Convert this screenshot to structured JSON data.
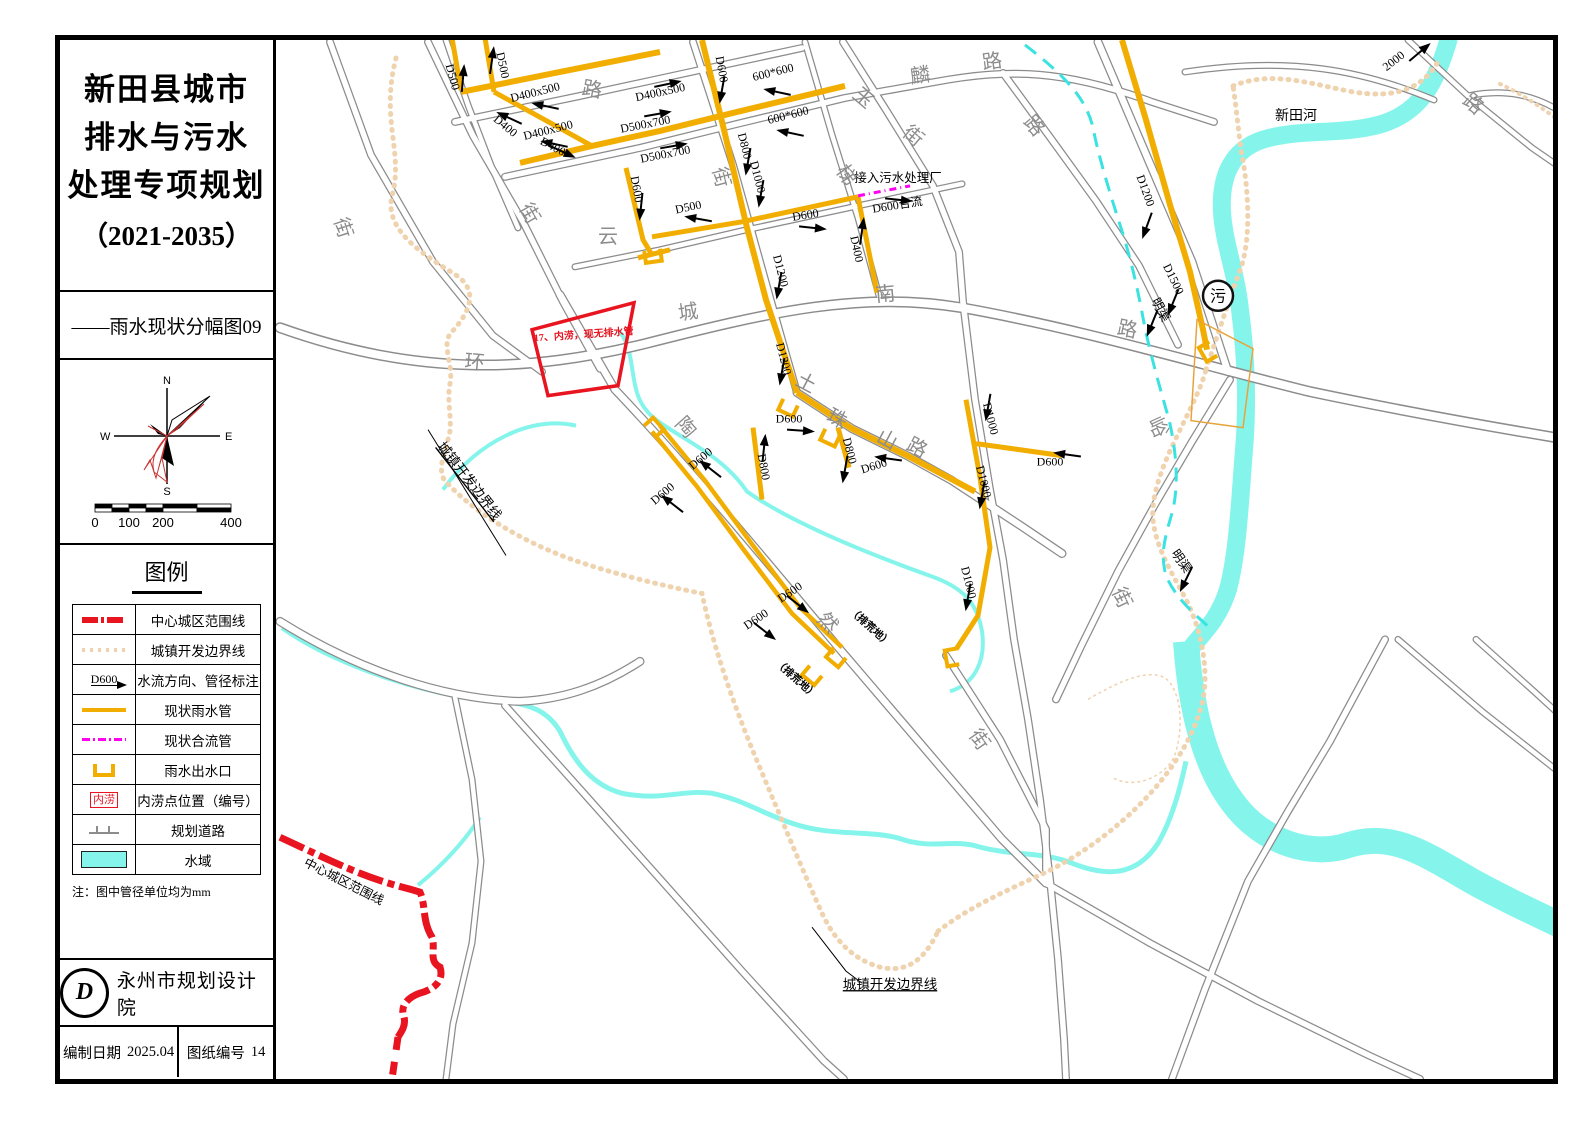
{
  "sidebar": {
    "title_lines": [
      "新田县城市",
      "排水与污水",
      "处理专项规划"
    ],
    "title_years": "（2021-2035）",
    "subtitle": "——雨水现状分幅图09",
    "compass": {
      "n": "N",
      "e": "E",
      "s": "S",
      "w": "W"
    },
    "scale": {
      "labels": [
        "0",
        "100",
        "200",
        "400"
      ]
    },
    "legend": {
      "heading": "图例",
      "flow_symbol_text": "D600",
      "flood_symbol_text": "内涝",
      "note": "注：图中管径单位均为mm",
      "items": [
        {
          "label": "中心城区范围线",
          "type": "red-dash"
        },
        {
          "label": "城镇开发边界线",
          "type": "tan-dot"
        },
        {
          "label": "水流方向、管径标注",
          "type": "flow"
        },
        {
          "label": "现状雨水管",
          "type": "rain-pipe"
        },
        {
          "label": "现状合流管",
          "type": "combined-pipe"
        },
        {
          "label": "雨水出水口",
          "type": "outfall"
        },
        {
          "label": "内涝点位置（编号）",
          "type": "flood-point"
        },
        {
          "label": "规划道路",
          "type": "planned-road"
        },
        {
          "label": "水域",
          "type": "water"
        }
      ]
    },
    "org": "永州市规划设计院",
    "logo_glyph": "D",
    "meta": {
      "date_label": "编制日期",
      "date": "2025.04",
      "sheet_label": "图纸编号",
      "sheet": "14"
    }
  },
  "map": {
    "colors": {
      "rain_pipe": "#F2AE00",
      "combined_pipe": "#FF00F0",
      "water": "#85F5EC",
      "boundary_urban": "#EFD3AF",
      "boundary_center": "#E81420",
      "road_casing": "#8C8C8C",
      "open_channel": "#3AE2E2"
    },
    "labels": [
      {
        "t": "D500",
        "x": 449,
        "y": 78,
        "r": 75
      },
      {
        "t": "D500",
        "x": 499,
        "y": 66,
        "r": 78
      },
      {
        "t": "D400x500",
        "x": 536,
        "y": 96,
        "r": -14
      },
      {
        "t": "D400x500",
        "x": 549,
        "y": 134,
        "r": -14
      },
      {
        "t": "D400x500",
        "x": 661,
        "y": 96,
        "r": -12
      },
      {
        "t": "D500x700",
        "x": 646,
        "y": 128,
        "r": -11
      },
      {
        "t": "D500x700",
        "x": 666,
        "y": 158,
        "r": -11
      },
      {
        "t": "D400",
        "x": 503,
        "y": 129,
        "r": 40
      },
      {
        "t": "D400",
        "x": 551,
        "y": 150,
        "r": 28
      },
      {
        "t": "D600",
        "x": 633,
        "y": 190,
        "r": 80
      },
      {
        "t": "D500",
        "x": 689,
        "y": 211,
        "r": -12
      },
      {
        "t": "D600",
        "x": 718,
        "y": 70,
        "r": 80
      },
      {
        "t": "D800",
        "x": 741,
        "y": 147,
        "r": 76
      },
      {
        "t": "D1000",
        "x": 754,
        "y": 178,
        "r": 76
      },
      {
        "t": "D1200",
        "x": 777,
        "y": 272,
        "r": 76
      },
      {
        "t": "600*600",
        "x": 774,
        "y": 76,
        "r": -14
      },
      {
        "t": "600*600",
        "x": 789,
        "y": 119,
        "r": -14
      },
      {
        "t": "D600",
        "x": 806,
        "y": 219,
        "r": -9
      },
      {
        "t": "D400",
        "x": 853,
        "y": 250,
        "r": 78
      },
      {
        "t": "D600合流",
        "x": 898,
        "y": 209,
        "r": -9
      },
      {
        "t": "D1200",
        "x": 780,
        "y": 360,
        "r": 76
      },
      {
        "t": "D600",
        "x": 789,
        "y": 423,
        "r": 0
      },
      {
        "t": "D800",
        "x": 846,
        "y": 452,
        "r": 76
      },
      {
        "t": "D600",
        "x": 875,
        "y": 470,
        "r": -17
      },
      {
        "t": "D800",
        "x": 760,
        "y": 468,
        "r": 80
      },
      {
        "t": "D1000",
        "x": 987,
        "y": 420,
        "r": 76
      },
      {
        "t": "D600",
        "x": 1050,
        "y": 466,
        "r": 0
      },
      {
        "t": "D1000",
        "x": 980,
        "y": 483,
        "r": 76
      },
      {
        "t": "D1000",
        "x": 965,
        "y": 584,
        "r": 76
      },
      {
        "t": "D600",
        "x": 792,
        "y": 596,
        "r": -34
      },
      {
        "t": "D600",
        "x": 758,
        "y": 623,
        "r": -34
      },
      {
        "t": "D600",
        "x": 703,
        "y": 462,
        "r": -40
      },
      {
        "t": "D600",
        "x": 665,
        "y": 497,
        "r": -40
      },
      {
        "t": "D1200",
        "x": 1142,
        "y": 192,
        "r": 70
      },
      {
        "t": "D1500",
        "x": 1170,
        "y": 281,
        "r": 64
      },
      {
        "t": "2000",
        "x": 1396,
        "y": 64,
        "r": -38
      },
      {
        "t": "接入污水处理厂",
        "x": 898,
        "y": 182,
        "r": 0,
        "c": "an"
      },
      {
        "t": "明渠",
        "x": 1157,
        "y": 312,
        "r": 62,
        "c": "an"
      },
      {
        "t": "明渠",
        "x": 1178,
        "y": 564,
        "r": 55,
        "c": "an"
      },
      {
        "t": "新田河",
        "x": 1296,
        "y": 120,
        "r": 0,
        "c": "riv"
      },
      {
        "t": "污",
        "x": 1218,
        "y": 302,
        "r": 0,
        "c": "plant"
      },
      {
        "t": "17、内涝，现无排水管",
        "x": 584,
        "y": 338,
        "r": -4,
        "c": "rc"
      },
      {
        "t": "城镇开发边界线",
        "x": 466,
        "y": 484,
        "r": 52,
        "c": "anu"
      },
      {
        "t": "城镇开发边界线",
        "x": 890,
        "y": 990,
        "r": 0,
        "c": "anu"
      },
      {
        "t": "中心城区范围线",
        "x": 342,
        "y": 886,
        "r": 27,
        "c": "an"
      },
      {
        "t": "（排荒地）",
        "x": 868,
        "y": 630,
        "r": 42,
        "c": "sm"
      },
      {
        "t": "（排荒地）",
        "x": 794,
        "y": 682,
        "r": 42,
        "c": "sm"
      },
      {
        "t": "街",
        "x": 337,
        "y": 230,
        "r": 72,
        "c": "rd"
      },
      {
        "t": "街",
        "x": 524,
        "y": 217,
        "r": 60,
        "c": "rd"
      },
      {
        "t": "路",
        "x": 591,
        "y": 96,
        "r": 10,
        "c": "rd"
      },
      {
        "t": "云",
        "x": 608,
        "y": 243,
        "r": 0,
        "c": "rd"
      },
      {
        "t": "街",
        "x": 715,
        "y": 179,
        "r": 75,
        "c": "rd"
      },
      {
        "t": "玉",
        "x": 859,
        "y": 103,
        "r": 40,
        "c": "rd"
      },
      {
        "t": "街",
        "x": 909,
        "y": 141,
        "r": 40,
        "c": "rd"
      },
      {
        "t": "麟",
        "x": 921,
        "y": 82,
        "r": -8,
        "c": "rd"
      },
      {
        "t": "路",
        "x": 993,
        "y": 68,
        "r": -8,
        "c": "rd"
      },
      {
        "t": "路",
        "x": 1029,
        "y": 130,
        "r": 50,
        "c": "rd"
      },
      {
        "t": "梯",
        "x": 841,
        "y": 179,
        "r": 55,
        "c": "rd"
      },
      {
        "t": "南",
        "x": 886,
        "y": 301,
        "r": -5,
        "c": "rd"
      },
      {
        "t": "路",
        "x": 1126,
        "y": 336,
        "r": 12,
        "c": "rd"
      },
      {
        "t": "城",
        "x": 689,
        "y": 319,
        "r": -8,
        "c": "rd"
      },
      {
        "t": "环",
        "x": 474,
        "y": 369,
        "r": 5,
        "c": "rd"
      },
      {
        "t": "陶",
        "x": 681,
        "y": 432,
        "r": 48,
        "c": "rd"
      },
      {
        "t": "土",
        "x": 803,
        "y": 389,
        "r": 28,
        "c": "rd"
      },
      {
        "t": "珠",
        "x": 834,
        "y": 425,
        "r": 28,
        "c": "rd"
      },
      {
        "t": "山",
        "x": 884,
        "y": 446,
        "r": 28,
        "c": "rd"
      },
      {
        "t": "路",
        "x": 914,
        "y": 454,
        "r": 28,
        "c": "rd"
      },
      {
        "t": "然",
        "x": 823,
        "y": 628,
        "r": 45,
        "c": "rd"
      },
      {
        "t": "街",
        "x": 974,
        "y": 744,
        "r": 55,
        "c": "rd"
      },
      {
        "t": "街",
        "x": 1116,
        "y": 601,
        "r": 65,
        "c": "rd"
      },
      {
        "t": "峪",
        "x": 1152,
        "y": 430,
        "r": 65,
        "c": "rd"
      },
      {
        "t": "路",
        "x": 1469,
        "y": 109,
        "r": 40,
        "c": "rd"
      }
    ],
    "arrows": [
      {
        "x": 463,
        "y": 78,
        "r": -85
      },
      {
        "x": 492,
        "y": 60,
        "r": -82
      },
      {
        "x": 545,
        "y": 106,
        "r": 192
      },
      {
        "x": 554,
        "y": 144,
        "r": 192
      },
      {
        "x": 668,
        "y": 84,
        "r": -12
      },
      {
        "x": 658,
        "y": 114,
        "r": -10
      },
      {
        "x": 674,
        "y": 146,
        "r": -10
      },
      {
        "x": 509,
        "y": 118,
        "r": 205
      },
      {
        "x": 563,
        "y": 152,
        "r": 25
      },
      {
        "x": 641,
        "y": 207,
        "r": 96
      },
      {
        "x": 698,
        "y": 219,
        "r": 190
      },
      {
        "x": 722,
        "y": 90,
        "r": 100
      },
      {
        "x": 748,
        "y": 162,
        "r": 100
      },
      {
        "x": 761,
        "y": 194,
        "r": 100
      },
      {
        "x": 779,
        "y": 286,
        "r": 100
      },
      {
        "x": 777,
        "y": 92,
        "r": 192
      },
      {
        "x": 790,
        "y": 133,
        "r": 192
      },
      {
        "x": 813,
        "y": 228,
        "r": 6
      },
      {
        "x": 862,
        "y": 231,
        "r": -82
      },
      {
        "x": 899,
        "y": 200,
        "r": 6
      },
      {
        "x": 782,
        "y": 372,
        "r": 100
      },
      {
        "x": 801,
        "y": 431,
        "r": 4
      },
      {
        "x": 845,
        "y": 470,
        "r": 100
      },
      {
        "x": 888,
        "y": 459,
        "r": 188
      },
      {
        "x": 764,
        "y": 448,
        "r": -84
      },
      {
        "x": 988,
        "y": 408,
        "r": 100
      },
      {
        "x": 1067,
        "y": 455,
        "r": 188
      },
      {
        "x": 982,
        "y": 496,
        "r": 100
      },
      {
        "x": 968,
        "y": 598,
        "r": 100
      },
      {
        "x": 798,
        "y": 605,
        "r": 38
      },
      {
        "x": 765,
        "y": 632,
        "r": 38
      },
      {
        "x": 710,
        "y": 469,
        "r": 218
      },
      {
        "x": 672,
        "y": 504,
        "r": 218
      },
      {
        "x": 1147,
        "y": 226,
        "r": 110
      },
      {
        "x": 1173,
        "y": 303,
        "r": 112
      },
      {
        "x": 1152,
        "y": 324,
        "r": 112
      },
      {
        "x": 1186,
        "y": 580,
        "r": 116
      },
      {
        "x": 1420,
        "y": 52,
        "r": -40
      }
    ],
    "outfalls": [
      {
        "x": 788,
        "y": 408,
        "r": 25
      },
      {
        "x": 830,
        "y": 438,
        "r": 25
      },
      {
        "x": 836,
        "y": 658,
        "r": 40
      },
      {
        "x": 812,
        "y": 676,
        "r": 40
      },
      {
        "x": 952,
        "y": 658,
        "r": 80
      },
      {
        "x": 654,
        "y": 428,
        "r": 228
      },
      {
        "x": 1208,
        "y": 352,
        "r": 60
      },
      {
        "x": 653,
        "y": 256,
        "r": -8
      }
    ]
  }
}
